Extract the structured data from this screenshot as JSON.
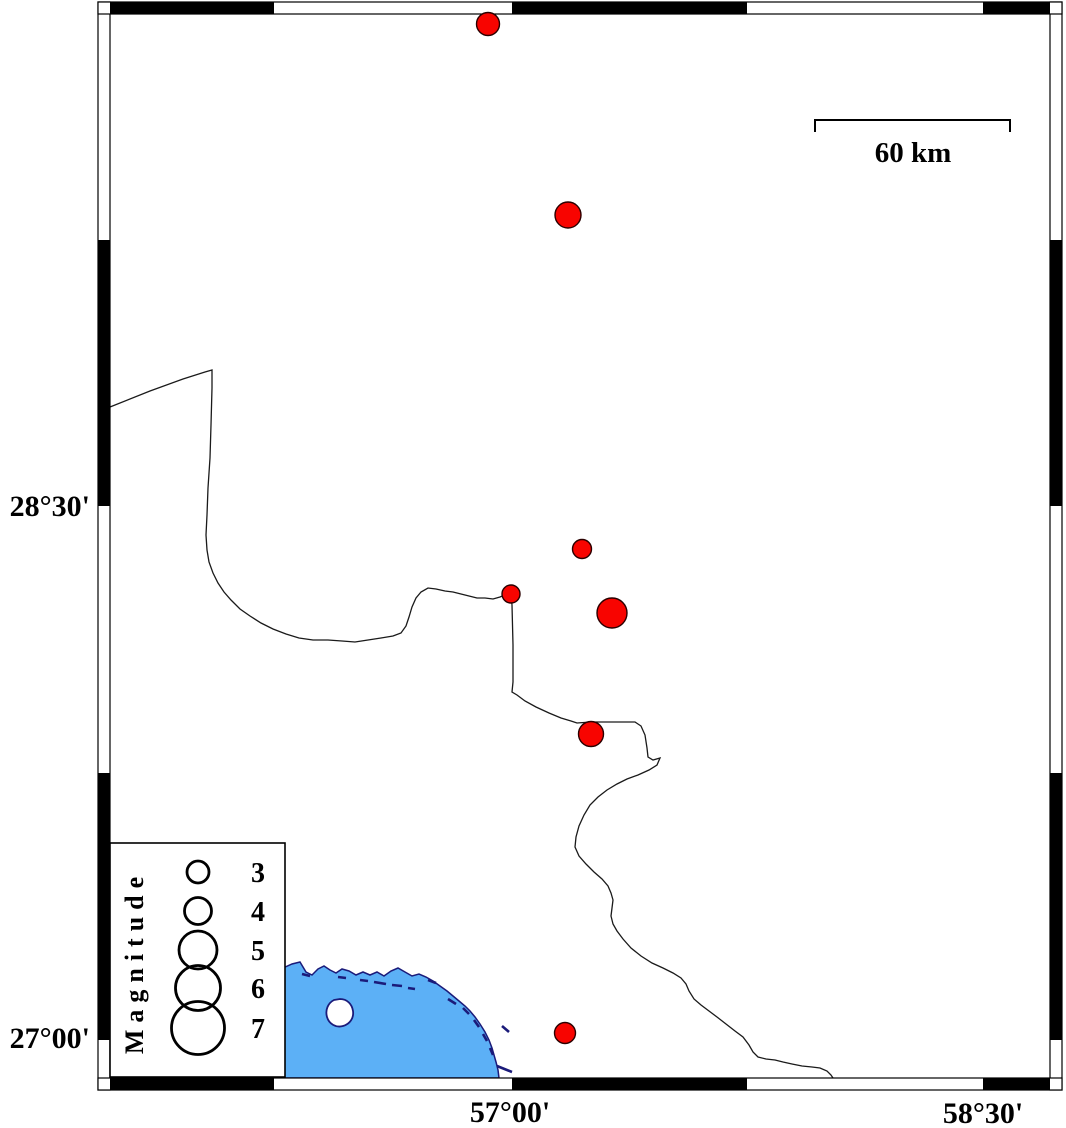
{
  "title": "Seismicity map with magnitude legend",
  "colors": {
    "background": "#ffffff",
    "frame_black": "#000000",
    "water_fill": "#5cb0f6",
    "coast_stroke": "#1b1b7a",
    "boundary_stroke": "#1a1a1a",
    "quake_fill": "#f80400",
    "quake_stroke": "#2a0000"
  },
  "axes": {
    "lat_labels": [
      {
        "text": "28°30'",
        "x": 90,
        "y": 506
      },
      {
        "text": "27°00'",
        "x": 90,
        "y": 1038
      }
    ],
    "lon_labels": [
      {
        "text": "57°00'",
        "x": 510,
        "y": 1112
      },
      {
        "text": "58°30'",
        "x": 983,
        "y": 1113
      }
    ]
  },
  "scale_bar": {
    "label": "60 km",
    "x1": 815,
    "x2": 1010,
    "y": 120,
    "tick_drop": 12,
    "label_x": 913,
    "label_y": 162
  },
  "legend": {
    "title": "Magnitude",
    "box": {
      "x": 110,
      "y": 843,
      "w": 175,
      "h": 234
    },
    "circle_cx": 198,
    "num_x": 258,
    "items": [
      {
        "label": "3",
        "cy": 872,
        "r": 11
      },
      {
        "label": "4",
        "cy": 911,
        "r": 13.5
      },
      {
        "label": "5",
        "cy": 950,
        "r": 19
      },
      {
        "label": "6",
        "cy": 988,
        "r": 22.5
      },
      {
        "label": "7",
        "cy": 1028,
        "r": 26.5
      }
    ]
  },
  "chart_data": {
    "type": "map-scatter",
    "title": "Earthquake epicenters (red circles scaled by magnitude)",
    "lon_ticks": [
      "57°00'",
      "58°30'"
    ],
    "lat_ticks": [
      "28°30'",
      "27°00'"
    ],
    "scale": "60 km",
    "legend_magnitudes": [
      3,
      4,
      5,
      6,
      7
    ],
    "points": [
      {
        "x": 488,
        "y": 24,
        "r": 11.5,
        "lon": "56°55'",
        "lat": "29°51'",
        "magnitude_approx": 3.2
      },
      {
        "x": 568,
        "y": 215,
        "r": 13,
        "lon": "57°11'",
        "lat": "29°19'",
        "magnitude_approx": 3.7
      },
      {
        "x": 582,
        "y": 549,
        "r": 9.5,
        "lon": "57°13'",
        "lat": "28°23'",
        "magnitude_approx": 2.8
      },
      {
        "x": 511,
        "y": 594,
        "r": 9,
        "lon": "57°00'",
        "lat": "28°15'",
        "magnitude_approx": 2.7
      },
      {
        "x": 612,
        "y": 613,
        "r": 15,
        "lon": "57°19'",
        "lat": "28°12'",
        "magnitude_approx": 4.2
      },
      {
        "x": 591,
        "y": 734,
        "r": 12.5,
        "lon": "57°15'",
        "lat": "27°52'",
        "magnitude_approx": 3.5
      },
      {
        "x": 565,
        "y": 1033,
        "r": 10.5,
        "lon": "57°10'",
        "lat": "27°01'",
        "magnitude_approx": 3.0
      }
    ]
  },
  "geometry": {
    "frame_bars": [
      {
        "x": 98,
        "y": 2,
        "w": 12,
        "h": 1088
      },
      {
        "x": 1050,
        "y": 2,
        "w": 12,
        "h": 1088
      },
      {
        "x": 98,
        "y": 2,
        "w": 964,
        "h": 12
      },
      {
        "x": 98,
        "y": 1078,
        "w": 964,
        "h": 12
      }
    ],
    "frame_black_segments": [
      {
        "x": 110,
        "y": 2,
        "w": 164,
        "h": 12
      },
      {
        "x": 512,
        "y": 2,
        "w": 235,
        "h": 12
      },
      {
        "x": 983,
        "y": 2,
        "w": 67,
        "h": 12
      },
      {
        "x": 110,
        "y": 1078,
        "w": 164,
        "h": 12
      },
      {
        "x": 512,
        "y": 1078,
        "w": 235,
        "h": 12
      },
      {
        "x": 983,
        "y": 1078,
        "w": 67,
        "h": 12
      },
      {
        "x": 98,
        "y": 240,
        "w": 12,
        "h": 266
      },
      {
        "x": 98,
        "y": 773,
        "w": 12,
        "h": 267
      },
      {
        "x": 1050,
        "y": 240,
        "w": 12,
        "h": 266
      },
      {
        "x": 1050,
        "y": 773,
        "w": 12,
        "h": 267
      }
    ],
    "water_path": "M283,968 L292,964 L300,962 L306,972 L312,975 L318,969 L324,966 L330,970 L336,973 L342,969 L349,971 L356,975 L363,972 L370,975 L377,972 L384,976 L391,971 L398,968 L405,972 L412,976 L419,974 L426,977 L433,981 L440,986 L447,991 L453,996 L459,1001 L465,1006 L470,1011 L475,1017 L480,1024 L485,1032 L489,1040 L492,1048 L494,1055 L496,1062 L498,1070 L499,1078 L283,1078 Z",
    "island_path": "M340,999 C347,999 352,1004 353,1011 C354,1018 350,1024 343,1026 C336,1028 329,1024 327,1017 C325,1010 328,1003 334,1000 Z",
    "coast_dashes": [
      "M302,974 L310,976",
      "M338,977 L346,978",
      "M360,980 L368,981",
      "M374,982 L386,984",
      "M392,985 L402,986",
      "M408,988 L415,989",
      "M428,980 L436,983",
      "M448,999 L456,1004",
      "M463,1008 L469,1014",
      "M474,1020 L479,1027",
      "M483,1034 L487,1041",
      "M490,1048 L493,1055",
      "M502,1026 L509,1032",
      "M497,1066 L512,1072"
    ],
    "boundary_path": "M110,407 L150,391 L183,379 L205,372 L212,370 L212,388 L211,425 L210,458 L208,488 L207,515 L206,535 L207,550 L209,562 L213,573 L218,583 L224,592 L231,600 L240,609 L250,616 L261,623 L273,629 L286,634 L299,638 L313,640 L328,640 L342,641 L355,642 L368,640 L381,638 L393,636 L401,633 L406,626 L409,617 L412,607 L416,598 L421,592 L428,588 L436,589 L445,591 L453,592 L461,594 L469,596 L477,598 L485,598 L493,599 L500,597 L507,594 L511,594 L512,605 L513,645 L513,682 L512,692 L517,695 L525,701 L536,707 L549,713 L561,718 L571,721 L577,723 L591,722 L606,722 L621,722 L635,722 L641,726 L645,735 L647,748 L648,757 L653,760 L660,758 L657,765 L649,770 L638,775 L627,779 L617,784 L607,790 L598,797 L590,805 L584,815 L579,826 L576,837 L575,847 L579,856 L586,864 L594,872 L602,879 L608,886 L611,893 L613,900 L612,908 L611,916 L613,924 L617,931 L623,939 L631,948 L641,956 L652,963 L663,968 L673,973 L681,978 L686,984 L689,991 L694,999 L701,1005 L709,1011 L717,1017 L726,1024 L735,1031 L743,1037 L749,1045 L753,1052 L758,1057 L766,1059 L775,1060 L783,1062 L792,1064 L802,1066 L812,1067 L820,1068 L827,1071 L831,1075 L833,1078",
    "scale_path": "M815,132 L815,120 L1010,120 L1010,132"
  }
}
